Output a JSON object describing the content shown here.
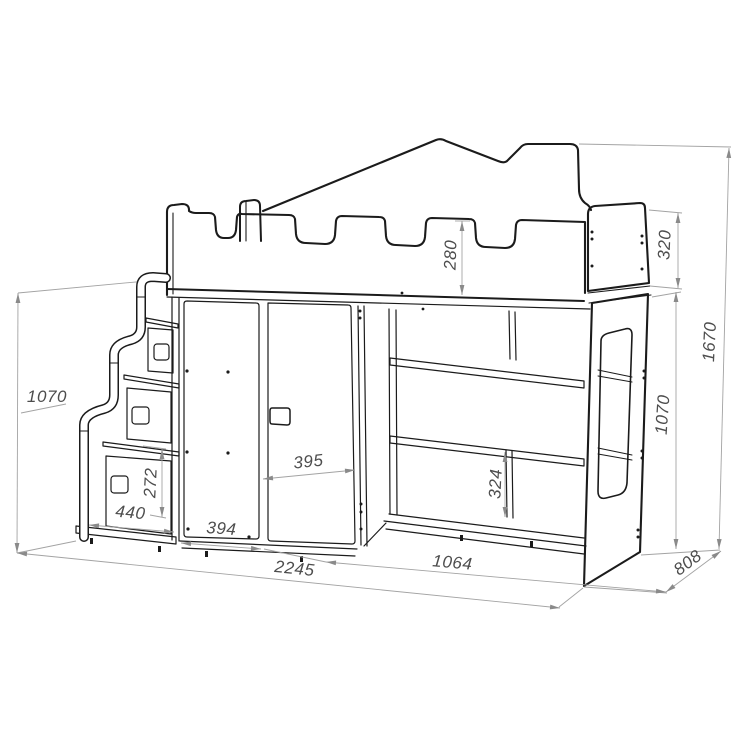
{
  "meta": {
    "description": "Dimensioned technical line drawing of a children's castle-style loft bed with staircase drawers, two-door wardrobe, open shelving and side panel with window cutout",
    "units": "mm"
  },
  "dimensions": {
    "guard_rail_height": "280",
    "headboard_height": "320",
    "overall_height": "1670",
    "left_side_height": "1070",
    "right_underbed_height": "1070",
    "stair_drawer_height": "272",
    "stair_step_width": "440",
    "left_door_width": "394",
    "right_door_width": "395",
    "shelf_divider_height": "324",
    "shelf_section_width": "1064",
    "overall_width": "2245",
    "overall_depth": "808"
  },
  "colors": {
    "outline": "#1b1b1b",
    "dimension_lines": "#a3a3a3",
    "dimension_text": "#4d4d4d",
    "background": "#ffffff"
  }
}
